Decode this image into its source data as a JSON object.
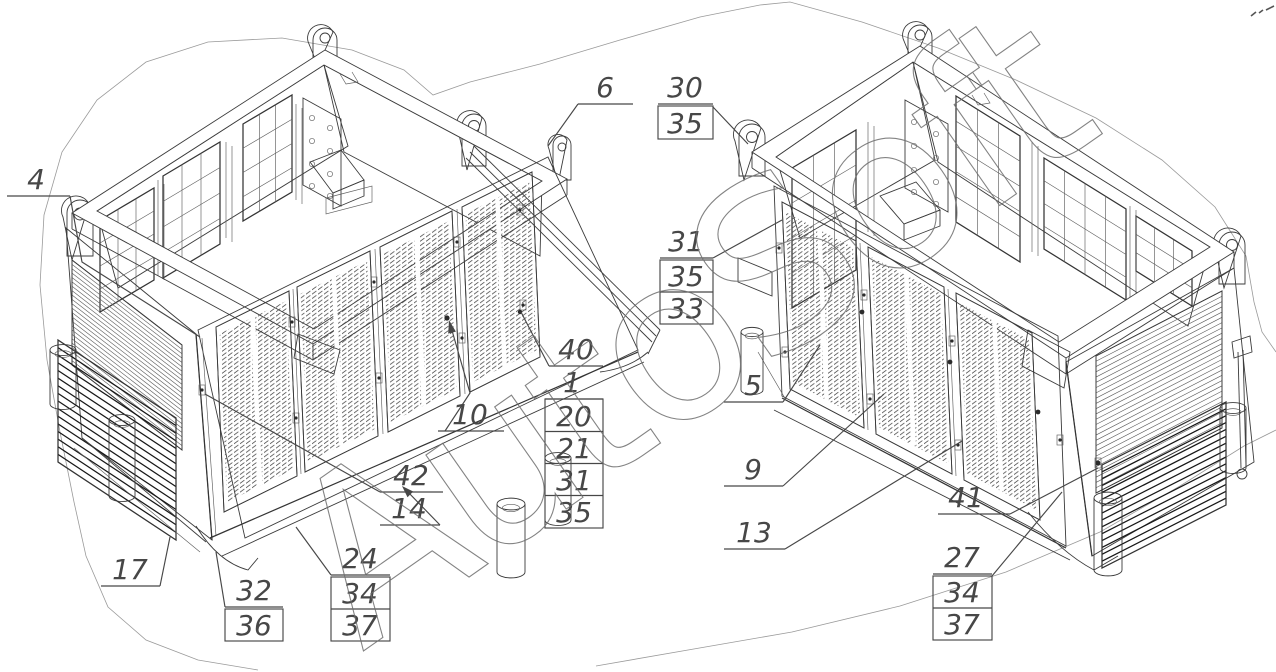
{
  "watermark": "AutoSoft",
  "callouts": {
    "left_view": {
      "c4": "4",
      "c6": "6",
      "c10": "10",
      "c42": "42",
      "c14": "14",
      "c40_stack": {
        "top": "40",
        "second": "1",
        "boxed": [
          "20",
          "21",
          "31",
          "35"
        ]
      },
      "c17": "17",
      "c32_36": {
        "top": "32",
        "boxed": [
          "36"
        ]
      },
      "c24_34_37": {
        "top": "24",
        "boxed": [
          "34",
          "37"
        ]
      }
    },
    "right_view": {
      "c30_35": {
        "top": "30",
        "boxed": [
          "35"
        ]
      },
      "c31_35_33": {
        "top": "31",
        "boxed": [
          "35",
          "33"
        ]
      },
      "c5": "5",
      "c9": "9",
      "c13": "13",
      "c41": "41",
      "c27_34_37": {
        "top": "27",
        "boxed": [
          "34",
          "37"
        ]
      }
    }
  }
}
